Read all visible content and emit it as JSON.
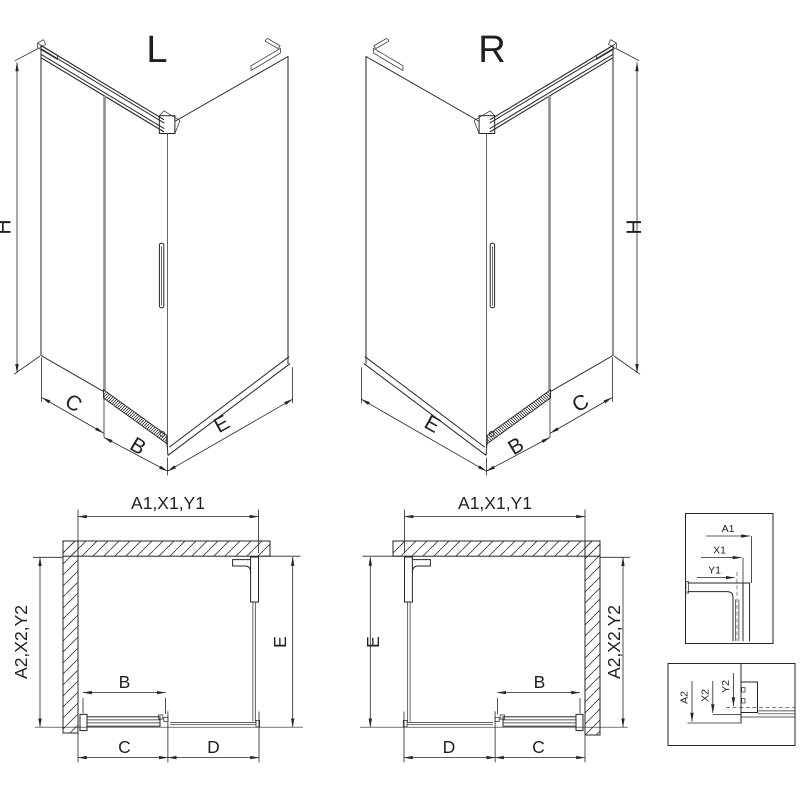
{
  "drawing": {
    "background": "#ffffff",
    "line_color": "#262626",
    "glass_edge_color": "#8f8f8f"
  },
  "iso_left": {
    "title": "L",
    "height_label": "H",
    "fixed_label": "C",
    "door_label": "B",
    "side_label": "E"
  },
  "iso_right": {
    "title": "R",
    "height_label": "H",
    "fixed_label": "C",
    "door_label": "B",
    "side_label": "E"
  },
  "plan_left": {
    "top_label": "A1,X1,Y1",
    "side_label": "A2,X2,Y2",
    "depth_label": "E",
    "door_label": "B",
    "bottom_left_label": "C",
    "bottom_right_label": "D"
  },
  "plan_right": {
    "top_label": "A1,X1,Y1",
    "side_label": "A2,X2,Y2",
    "depth_label": "E",
    "door_label": "B",
    "bottom_left_label": "D",
    "bottom_right_label": "C"
  },
  "detail_top": {
    "labels": [
      "A1",
      "X1",
      "Y1"
    ]
  },
  "detail_bottom": {
    "labels": [
      "A2",
      "X2",
      "Y2"
    ]
  }
}
